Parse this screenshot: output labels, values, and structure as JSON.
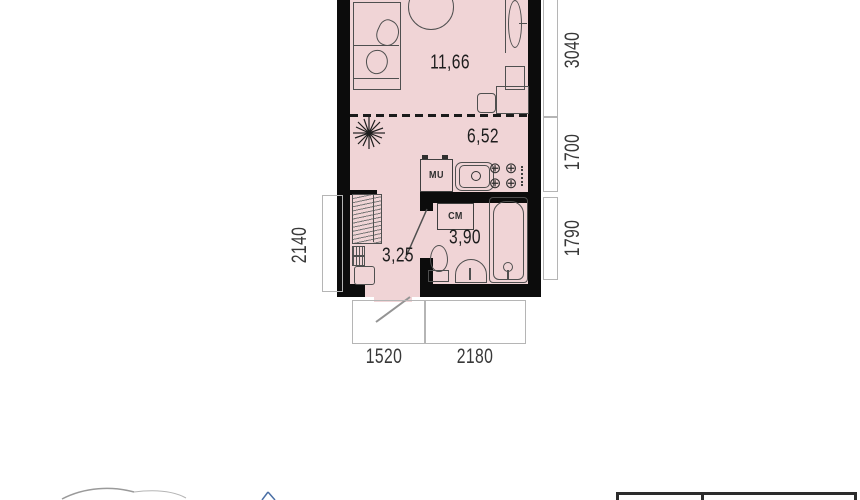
{
  "plan": {
    "rooms": [
      {
        "id": "living-room",
        "area": "11,66"
      },
      {
        "id": "kitchen",
        "area": "6,52"
      },
      {
        "id": "bathroom",
        "area": "3,90"
      },
      {
        "id": "hallway",
        "area": "3,25"
      }
    ],
    "appliance_labels": {
      "washer_unit": "МU",
      "washing_machine": "СМ"
    },
    "dimensions": {
      "right": [
        "3040",
        "1700",
        "1790"
      ],
      "left": "2140",
      "bottom": [
        "1520",
        "2180"
      ]
    },
    "icons": {
      "burner": "⊕"
    },
    "colors": {
      "room_fill": "#f0d4d6",
      "wall": "#0c0c0c",
      "furniture_stroke": "#4f4f4f",
      "dimension_line": "#b5b5b5"
    }
  }
}
